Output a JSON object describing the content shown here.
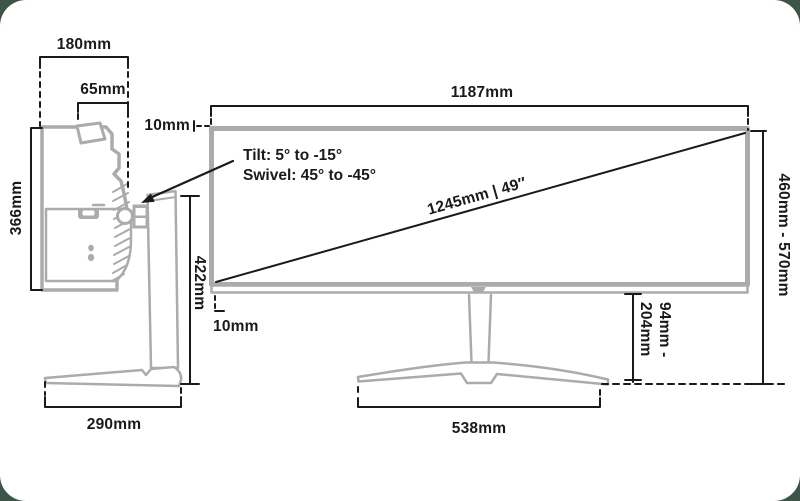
{
  "colors": {
    "background": "#3F5449",
    "card": "#FFFFFF",
    "dimension_line": "#1A1A1A",
    "product_line": "#ABABAB"
  },
  "side_view": {
    "top_width": "180mm",
    "upper_depth": "65mm",
    "screen_height": "366mm",
    "stand_height": "422mm",
    "base_depth": "290mm"
  },
  "front_view": {
    "screen_width": "1187mm",
    "top_bezel_gap": "10mm",
    "bottom_bezel_gap": "10mm",
    "diagonal": "1245mm | 49″",
    "tilt": "Tilt: 5° to -15°",
    "swivel": "Swivel: 45° to -45°",
    "total_height_range": "460mm - 570mm",
    "stand_clearance_line1": "94mm -",
    "stand_clearance_line2": "204mm",
    "base_width": "538mm"
  }
}
